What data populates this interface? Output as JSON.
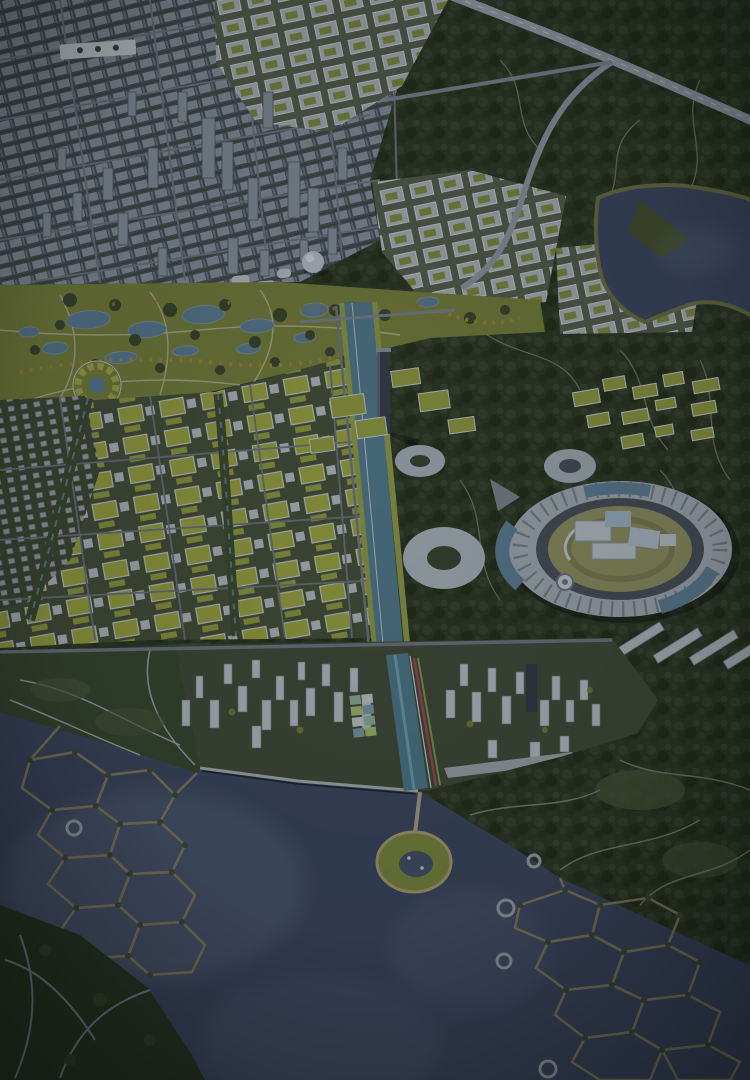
{
  "colors": {
    "forest_green": "#2e3a28",
    "park_green": "#75803e",
    "pond_blue": "#5b7d93",
    "autumn_gold": "#9c8538",
    "autumn_amber": "#8f7430",
    "city_light": "#87929e",
    "city_shadow": "#4d5762",
    "road_grey": "#79838f",
    "highway_grey": "#97a0aa",
    "green_roof": "#8f9a42",
    "white_building": "#b7c0c7",
    "canal_water": "#527a8c",
    "canal_bank": "#8d9a4a",
    "lake_water": "#3e4a63",
    "lake_light": "#66748a",
    "ring_white": "#a2acb5",
    "ring_glass": "#5e7f96",
    "ring_channel": "#49525b",
    "inner_lawn": "#8f9162",
    "island_edge": "#857d60",
    "island_green": "#7c8a41",
    "stripe_red": "#a34757",
    "stripe_green": "#7e9a4c",
    "promenade": "#a9b1b7",
    "dome_white": "#b8c2ca",
    "riverside_green": "#3a4a32",
    "town_ground": "#424d3a",
    "headland_green": "#2c3926",
    "slab_white": "#b2bac1"
  }
}
